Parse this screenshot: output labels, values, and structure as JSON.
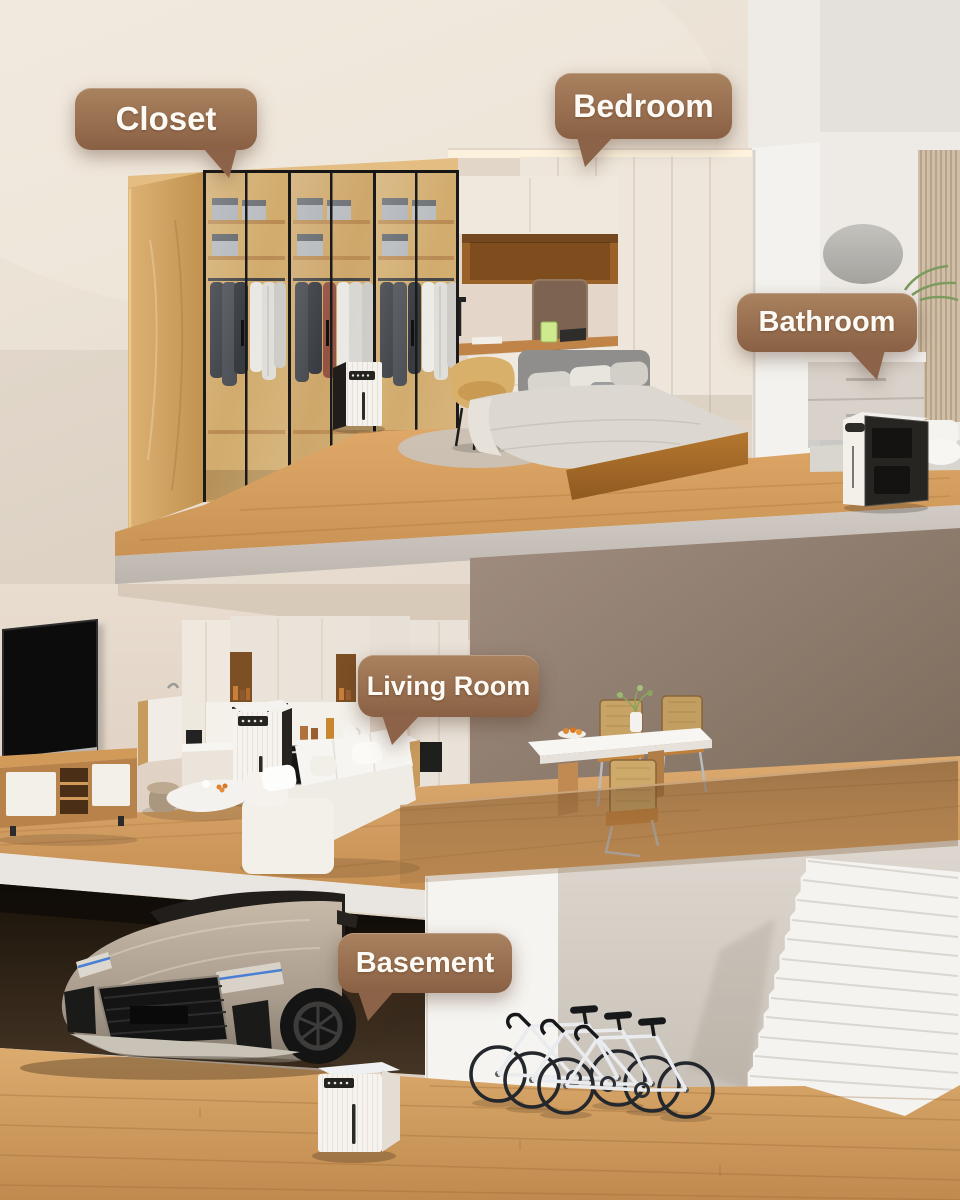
{
  "scene": {
    "description": "3D cutaway render of a two-story house with basement; a white dehumidifier is placed in the closet, bathroom, living room and basement",
    "floors": [
      "upper floor",
      "main floor",
      "basement"
    ],
    "objects": [
      "wardrobe with glass doors",
      "bed",
      "desk and chair",
      "bathroom vanity and round mirror",
      "toilet",
      "wall TV",
      "TV stand",
      "kitchen cabinets",
      "coffee table",
      "white sofa",
      "dining table with cane chairs",
      "white staircase",
      "silver sports car",
      "three road bikes",
      "four dehumidifiers"
    ]
  },
  "labels": {
    "closet": "Closet",
    "bedroom": "Bedroom",
    "bathroom": "Bathroom",
    "living_room": "Living Room",
    "basement": "Basement"
  },
  "colors": {
    "label_bubble_top": "#a9825f",
    "label_bubble_bottom": "#8a6044",
    "label_text": "#fdfaf5",
    "wall_beige": "#e8ddd1",
    "wall_taupe": "#8f7d70",
    "wood_floor": "#d3a065",
    "closet_wood": "#d7ab6c",
    "slab_gray": "#c9c1ba",
    "stairs_white": "#f4f3f0",
    "device_body": "#f5f2ed",
    "device_panel": "#262522",
    "car_body": "#b7a999",
    "garage_shadow": "#241b12"
  }
}
